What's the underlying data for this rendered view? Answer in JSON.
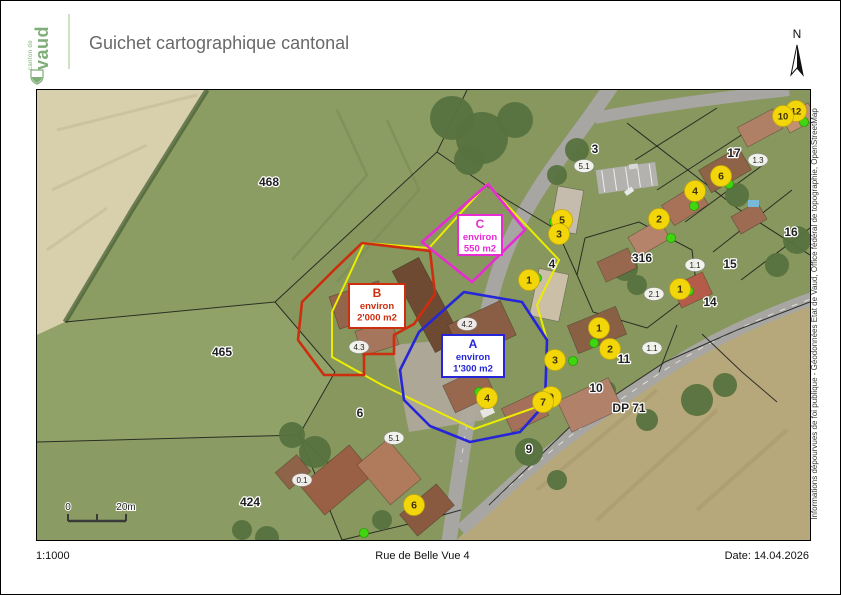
{
  "page": {
    "header": {
      "logo_small": "canton de",
      "logo_big": "vaud",
      "title": "Guichet cartographique cantonal"
    },
    "north_label": "N",
    "attribution": "Informations dépourvues de foi publique - Géodonnées Etat de Vaud, Office fédéral de topographie, OpenStreetMap",
    "footer": {
      "scale": "1:1000",
      "address": "Rue de Belle Vue 4",
      "date": "Date: 14.04.2026"
    }
  },
  "map": {
    "scalebar": {
      "start": "0",
      "end": "20m"
    },
    "highlight_outline": {
      "color": "#ecec00",
      "polygon": [
        [
          450,
          94
        ],
        [
          522,
          170
        ],
        [
          500,
          215
        ],
        [
          510,
          250
        ],
        [
          508,
          314
        ],
        [
          437,
          339
        ],
        [
          345,
          295
        ],
        [
          295,
          267
        ],
        [
          295,
          222
        ],
        [
          327,
          153
        ],
        [
          392,
          158
        ]
      ]
    },
    "zones": [
      {
        "id": "C",
        "label_lines": [
          "C",
          "environ",
          "550 m2"
        ],
        "color": "#e82cd4",
        "box": {
          "x": 421,
          "y": 125,
          "w": 44,
          "h": 40
        },
        "polygon": [
          [
            451,
            94
          ],
          [
            488,
            140
          ],
          [
            435,
            192
          ],
          [
            385,
            152
          ]
        ]
      },
      {
        "id": "B",
        "label_lines": [
          "B",
          "environ",
          "2'000 m2"
        ],
        "color": "#cc2e0e",
        "box": {
          "x": 312,
          "y": 194,
          "w": 56,
          "h": 44
        },
        "polygon": [
          [
            325,
            153
          ],
          [
            393,
            161
          ],
          [
            398,
            204
          ],
          [
            377,
            234
          ],
          [
            357,
            245
          ],
          [
            357,
            264
          ],
          [
            327,
            264
          ],
          [
            327,
            285
          ],
          [
            287,
            285
          ],
          [
            261,
            250
          ],
          [
            265,
            212
          ],
          [
            297,
            180
          ]
        ]
      },
      {
        "id": "A",
        "label_lines": [
          "A",
          "environ",
          "1'300 m2"
        ],
        "color": "#2626d8",
        "box": {
          "x": 405,
          "y": 245,
          "w": 62,
          "h": 42
        },
        "polygon": [
          [
            427,
            202
          ],
          [
            485,
            212
          ],
          [
            510,
            250
          ],
          [
            508,
            314
          ],
          [
            483,
            342
          ],
          [
            433,
            352
          ],
          [
            393,
            336
          ],
          [
            367,
            310
          ],
          [
            363,
            280
          ],
          [
            382,
            242
          ]
        ]
      }
    ],
    "parcel_labels": [
      {
        "t": "468",
        "x": 232,
        "y": 96
      },
      {
        "t": "465",
        "x": 185,
        "y": 266
      },
      {
        "t": "424",
        "x": 213,
        "y": 416
      },
      {
        "t": "3",
        "x": 558,
        "y": 63
      },
      {
        "t": "17",
        "x": 697,
        "y": 67
      },
      {
        "t": "316",
        "x": 605,
        "y": 172
      },
      {
        "t": "4",
        "x": 515,
        "y": 178
      },
      {
        "t": "14",
        "x": 673,
        "y": 216
      },
      {
        "t": "15",
        "x": 693,
        "y": 178
      },
      {
        "t": "16",
        "x": 754,
        "y": 146
      },
      {
        "t": "11",
        "x": 587,
        "y": 273
      },
      {
        "t": "10",
        "x": 559,
        "y": 302
      },
      {
        "t": "6",
        "x": 323,
        "y": 327
      },
      {
        "t": "9",
        "x": 492,
        "y": 363
      },
      {
        "t": "DP 71",
        "x": 592,
        "y": 322
      }
    ],
    "building_labels": [
      {
        "t": "5.1",
        "x": 547,
        "y": 76
      },
      {
        "t": "1.3",
        "x": 721,
        "y": 70
      },
      {
        "t": "1.1",
        "x": 658,
        "y": 175
      },
      {
        "t": "2.1",
        "x": 617,
        "y": 204
      },
      {
        "t": "1.1",
        "x": 615,
        "y": 258
      },
      {
        "t": "5.1",
        "x": 357,
        "y": 348
      },
      {
        "t": "4.3",
        "x": 322,
        "y": 257
      },
      {
        "t": "4.2",
        "x": 430,
        "y": 234
      },
      {
        "t": "0.1",
        "x": 265,
        "y": 390
      }
    ],
    "markers": [
      {
        "n": "12",
        "x": 759,
        "y": 21
      },
      {
        "n": "10",
        "x": 746,
        "y": 26
      },
      {
        "n": "6",
        "x": 684,
        "y": 86
      },
      {
        "n": "4",
        "x": 658,
        "y": 101
      },
      {
        "n": "2",
        "x": 622,
        "y": 129
      },
      {
        "n": "5",
        "x": 525,
        "y": 130
      },
      {
        "n": "3",
        "x": 522,
        "y": 144
      },
      {
        "n": "1",
        "x": 492,
        "y": 190
      },
      {
        "n": "1",
        "x": 643,
        "y": 199
      },
      {
        "n": "1",
        "x": 562,
        "y": 238
      },
      {
        "n": "2",
        "x": 573,
        "y": 259
      },
      {
        "n": "3",
        "x": 518,
        "y": 270
      },
      {
        "n": "9",
        "x": 514,
        "y": 307
      },
      {
        "n": "7",
        "x": 506,
        "y": 312
      },
      {
        "n": "4",
        "x": 450,
        "y": 308
      },
      {
        "n": "6",
        "x": 377,
        "y": 415
      }
    ],
    "green_dots": [
      [
        767,
        32
      ],
      [
        692,
        94
      ],
      [
        657,
        116
      ],
      [
        634,
        148
      ],
      [
        517,
        132
      ],
      [
        500,
        188
      ],
      [
        652,
        201
      ],
      [
        557,
        253
      ],
      [
        536,
        271
      ],
      [
        442,
        302
      ],
      [
        327,
        443
      ]
    ],
    "marker_color": "#f3d609",
    "green_dot_color": "#3ed60e"
  }
}
